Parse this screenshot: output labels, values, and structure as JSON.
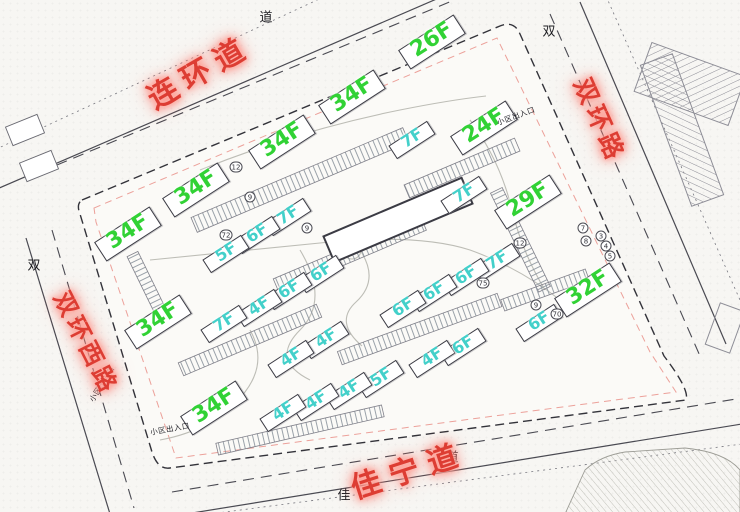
{
  "map": {
    "title_hint": "residential site plan",
    "colors": {
      "high_rise_label": "#31d235",
      "low_rise_label": "#43d0ca",
      "road_label": "#dd3d33",
      "line": "#3b3b44",
      "paper": "#f7f6f3"
    },
    "roads": [
      {
        "name": "连环道",
        "x": 198,
        "y": 70,
        "rot": -30,
        "size": 30,
        "spacing": 8
      },
      {
        "name": "双环路",
        "x": 601,
        "y": 120,
        "rot": 66,
        "size": 25,
        "spacing": 5
      },
      {
        "name": "双环西路",
        "x": 88,
        "y": 342,
        "rot": 63,
        "size": 24,
        "spacing": 4
      },
      {
        "name": "佳宁道",
        "x": 408,
        "y": 468,
        "rot": -18,
        "size": 30,
        "spacing": 10
      }
    ],
    "road_chars": [
      {
        "text": "道",
        "x": 266,
        "y": 16
      },
      {
        "text": "双",
        "x": 549,
        "y": 30
      },
      {
        "text": "双",
        "x": 34,
        "y": 264
      },
      {
        "text": "佳",
        "x": 344,
        "y": 494
      },
      {
        "text": "道",
        "x": 452,
        "y": 456
      }
    ],
    "entrances": [
      {
        "text": "小区出入口",
        "x": 516,
        "y": 116,
        "rot": -20
      },
      {
        "text": "小区出入口",
        "x": 102,
        "y": 384,
        "rot": -58
      },
      {
        "text": "小区出入口",
        "x": 170,
        "y": 429,
        "rot": -10
      }
    ],
    "buildings": [
      {
        "t": "26F",
        "x": 432,
        "y": 40,
        "kind": "high"
      },
      {
        "t": "34F",
        "x": 352,
        "y": 95,
        "kind": "high"
      },
      {
        "t": "34F",
        "x": 282,
        "y": 140,
        "kind": "high"
      },
      {
        "t": "24F",
        "x": 484,
        "y": 126,
        "kind": "high"
      },
      {
        "t": "34F",
        "x": 196,
        "y": 188,
        "kind": "high"
      },
      {
        "t": "34F",
        "x": 128,
        "y": 232,
        "kind": "high"
      },
      {
        "t": "34F",
        "x": 158,
        "y": 320,
        "kind": "high"
      },
      {
        "t": "34F",
        "x": 214,
        "y": 406,
        "kind": "high"
      },
      {
        "t": "29F",
        "x": 528,
        "y": 200,
        "kind": "high"
      },
      {
        "t": "32F",
        "x": 588,
        "y": 288,
        "kind": "high"
      },
      {
        "t": "7F",
        "x": 412,
        "y": 138,
        "kind": "low"
      },
      {
        "t": "7F",
        "x": 464,
        "y": 193,
        "kind": "low"
      },
      {
        "t": "7F",
        "x": 288,
        "y": 215,
        "kind": "low"
      },
      {
        "t": "6F",
        "x": 257,
        "y": 233,
        "kind": "low"
      },
      {
        "t": "5F",
        "x": 226,
        "y": 252,
        "kind": "low"
      },
      {
        "t": "6F",
        "x": 321,
        "y": 272,
        "kind": "low"
      },
      {
        "t": "6F",
        "x": 289,
        "y": 289,
        "kind": "low"
      },
      {
        "t": "4F",
        "x": 259,
        "y": 306,
        "kind": "low"
      },
      {
        "t": "7F",
        "x": 224,
        "y": 322,
        "kind": "low"
      },
      {
        "t": "7F",
        "x": 497,
        "y": 260,
        "kind": "low"
      },
      {
        "t": "6F",
        "x": 466,
        "y": 275,
        "kind": "low"
      },
      {
        "t": "6F",
        "x": 434,
        "y": 291,
        "kind": "low"
      },
      {
        "t": "6F",
        "x": 403,
        "y": 307,
        "kind": "low"
      },
      {
        "t": "6F",
        "x": 539,
        "y": 321,
        "kind": "low"
      },
      {
        "t": "6F",
        "x": 463,
        "y": 345,
        "kind": "low"
      },
      {
        "t": "4F",
        "x": 432,
        "y": 357,
        "kind": "low"
      },
      {
        "t": "4F",
        "x": 326,
        "y": 338,
        "kind": "low"
      },
      {
        "t": "4F",
        "x": 291,
        "y": 357,
        "kind": "low"
      },
      {
        "t": "5F",
        "x": 381,
        "y": 377,
        "kind": "low"
      },
      {
        "t": "4F",
        "x": 349,
        "y": 389,
        "kind": "low"
      },
      {
        "t": "4F",
        "x": 316,
        "y": 400,
        "kind": "low"
      },
      {
        "t": "4F",
        "x": 283,
        "y": 411,
        "kind": "low"
      }
    ],
    "bubbles": [
      {
        "n": "12",
        "x": 236,
        "y": 167
      },
      {
        "n": "9",
        "x": 250,
        "y": 197
      },
      {
        "n": "9",
        "x": 307,
        "y": 228
      },
      {
        "n": "72",
        "x": 226,
        "y": 235
      },
      {
        "n": "75",
        "x": 483,
        "y": 283
      },
      {
        "n": "12",
        "x": 520,
        "y": 243
      },
      {
        "n": "7",
        "x": 583,
        "y": 228
      },
      {
        "n": "8",
        "x": 586,
        "y": 241
      },
      {
        "n": "3",
        "x": 601,
        "y": 236
      },
      {
        "n": "4",
        "x": 606,
        "y": 246
      },
      {
        "n": "5",
        "x": 610,
        "y": 256
      },
      {
        "n": "9",
        "x": 536,
        "y": 305
      },
      {
        "n": "70",
        "x": 557,
        "y": 314
      }
    ],
    "label_rotation": -33
  }
}
